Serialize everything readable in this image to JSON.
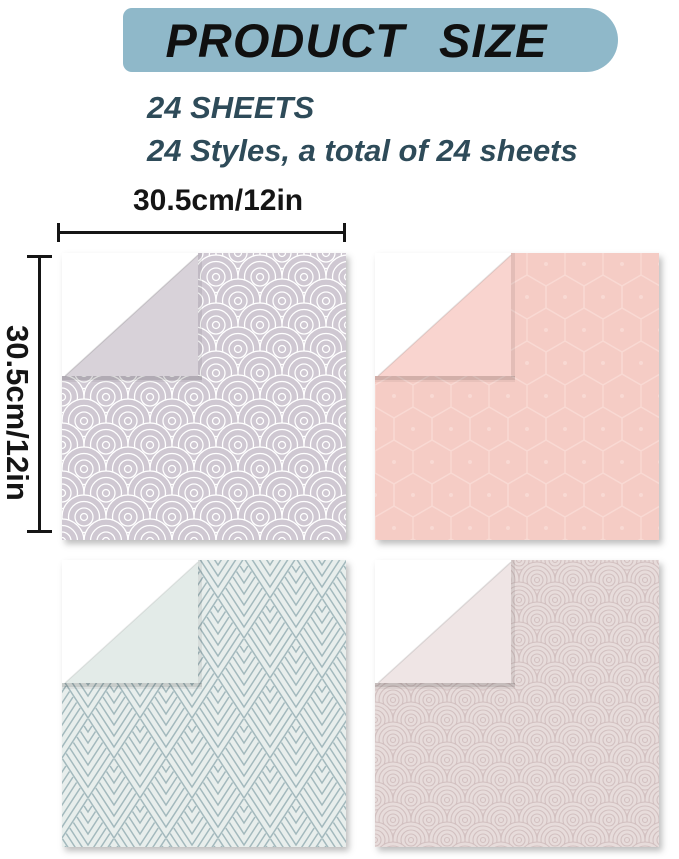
{
  "banner": {
    "title": "PRODUCT SIZE"
  },
  "subtitle": {
    "line1": "24 SHEETS",
    "line2": "24 Styles, a total of 24 sheets"
  },
  "dimensions": {
    "width_label": "30.5cm/12in",
    "height_label": "30.5cm/12in"
  },
  "swatches": [
    {
      "name": "lavender-fan-arc-paper",
      "pattern": "fan-arcs",
      "base_color": "#cfc8d2",
      "pattern_line_color": "#ffffff",
      "back_color": "#d8d2d9"
    },
    {
      "name": "pink-honeycomb-paper",
      "pattern": "honeycomb",
      "base_color": "#f5ccc5",
      "pattern_line_color": "#f9d9d3",
      "back_color": "#f9d4cf"
    },
    {
      "name": "mint-deco-leaf-paper",
      "pattern": "deco-leaf",
      "base_color": "#e8eeec",
      "pattern_line_color": "#a3b9bd",
      "back_color": "#e3ebe8"
    },
    {
      "name": "mauve-scallop-paper",
      "pattern": "scallops",
      "base_color": "#e7dcdb",
      "pattern_line_color": "#d2c0c0",
      "back_color": "#efe5e5"
    }
  ],
  "colors": {
    "page_bg": "#ffffff",
    "banner_bg": "#8fb8c9",
    "title_color": "#101010",
    "subtitle_color": "#2e4b59",
    "dim_color": "#151515"
  }
}
